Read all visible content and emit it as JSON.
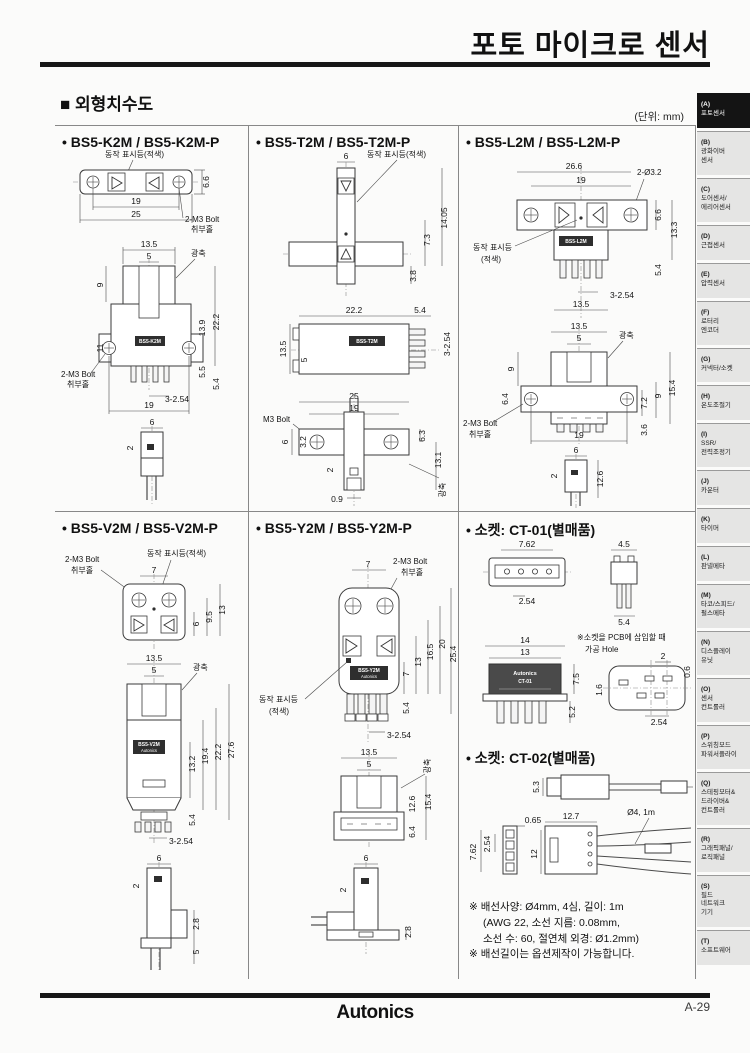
{
  "page": {
    "title": "포토 마이크로 센서",
    "section_title": "■ 외형치수도",
    "unit_note": "(단위: mm)",
    "footer_logo": "Autonics",
    "page_number": "A-29",
    "accent_color": "#171717"
  },
  "sidebar": {
    "items": [
      {
        "key": "(A)",
        "label": "포토센서",
        "active": true
      },
      {
        "key": "(B)",
        "label": "광화이버\n센서",
        "active": false
      },
      {
        "key": "(C)",
        "label": "도어센서/\n에리어센서",
        "active": false
      },
      {
        "key": "(D)",
        "label": "근접센서",
        "active": false
      },
      {
        "key": "(E)",
        "label": "압력센서",
        "active": false
      },
      {
        "key": "(F)",
        "label": "로터리\n엔코더",
        "active": false
      },
      {
        "key": "(G)",
        "label": "커넥터/소켓",
        "active": false
      },
      {
        "key": "(H)",
        "label": "온도조절기",
        "active": false
      },
      {
        "key": "(I)",
        "label": "SSR/\n전력조정기",
        "active": false
      },
      {
        "key": "(J)",
        "label": "카운터",
        "active": false
      },
      {
        "key": "(K)",
        "label": "타이머",
        "active": false
      },
      {
        "key": "(L)",
        "label": "판넬메타",
        "active": false
      },
      {
        "key": "(M)",
        "label": "타코/스피드/\n펄스메타",
        "active": false
      },
      {
        "key": "(N)",
        "label": "디스플레이\n유닛",
        "active": false
      },
      {
        "key": "(O)",
        "label": "센서\n컨트롤러",
        "active": false
      },
      {
        "key": "(P)",
        "label": "스위칭모드\n파워서플라이",
        "active": false
      },
      {
        "key": "(Q)",
        "label": "스테핑모터&\n드라이버&\n컨트롤러",
        "active": false
      },
      {
        "key": "(R)",
        "label": "그래픽패널/\n로직패널",
        "active": false
      },
      {
        "key": "(S)",
        "label": "필드\n네트워크\n기기",
        "active": false
      },
      {
        "key": "(T)",
        "label": "소프트웨어",
        "active": false
      }
    ]
  },
  "panels": {
    "k2m": {
      "title": "• BS5-K2M / BS5-K2M-P",
      "indicator": "동작 표시등(적색)",
      "bolt": "2-M3 Bolt",
      "bolt_hole": "취부홀",
      "axis": "광축",
      "model": "BS5-K2M",
      "pitch": "3-2.54",
      "top": [
        "19",
        "25",
        "6.6"
      ],
      "front": [
        "13.5",
        "5",
        "9",
        "11",
        "13.9",
        "22.2",
        "5.5",
        "5.4",
        "19"
      ],
      "side": [
        "6",
        "0.9",
        "2"
      ]
    },
    "t2m": {
      "title": "• BS5-T2M / BS5-T2M-P",
      "indicator": "동작 표시등(적색)",
      "axis": "광축",
      "bolt": "M3 Bolt",
      "model": "BS5-T2M",
      "pitch": "3-2.54",
      "top": [
        "6",
        "14.05",
        "7.3",
        "3.8"
      ],
      "mid": [
        "22.2",
        "5.4",
        "13.5",
        "5"
      ],
      "bottom": [
        "25",
        "19",
        "6",
        "3.2",
        "6.3",
        "13.1",
        "2",
        "0.9"
      ]
    },
    "l2m": {
      "title": "• BS5-L2M / BS5-L2M-P",
      "indicator_1": "동작 표시등",
      "indicator_2": "(적색)",
      "holes": "2-Ø3.2",
      "bolt": "2-M3 Bolt",
      "bolt_hole": "취부홀",
      "axis": "광축",
      "model": "BS5-L2M",
      "pitch": "3-2.54",
      "top": [
        "26.6",
        "19",
        "6.6",
        "13.3",
        "5.4",
        "13.5"
      ],
      "front": [
        "13.5",
        "5",
        "9",
        "6.4",
        "7.2",
        "9",
        "15.4",
        "3.6",
        "19"
      ],
      "side": [
        "6",
        "0.9",
        "2",
        "12.6"
      ]
    },
    "v2m": {
      "title": "• BS5-V2M / BS5-V2M-P",
      "bolt": "2-M3 Bolt",
      "bolt_hole": "취부홀",
      "indicator": "동작 표시등(적색)",
      "axis": "광축",
      "model": "BS5-V2M",
      "brand": "Autonics",
      "pitch": "3-2.54",
      "top": [
        "7",
        "6",
        "9.5",
        "13"
      ],
      "front": [
        "13.5",
        "5",
        "13.2",
        "19.4",
        "22.2",
        "27.6",
        "5.4"
      ],
      "side": [
        "6",
        "0.9",
        "2",
        "2.8",
        "5"
      ]
    },
    "y2m": {
      "title": "• BS5-Y2M / BS5-Y2M-P",
      "bolt": "2-M3 Bolt",
      "bolt_hole": "취부홀",
      "indicator_1": "동작 표시등",
      "indicator_2": "(적색)",
      "axis": "광축",
      "model": "BS5-Y2M",
      "brand": "Autonics",
      "pitch": "3-2.54",
      "front": [
        "7",
        "7",
        "13",
        "16.5",
        "20",
        "25.4",
        "5.4"
      ],
      "mid": [
        "13.5",
        "5",
        "12.6",
        "15.4",
        "6.4"
      ],
      "side": [
        "6",
        "0.9",
        "2",
        "2.8"
      ]
    },
    "sockets": {
      "ct01_title": "• 소켓: CT-01(별매품)",
      "ct02_title": "• 소켓: CT-02(별매품)",
      "pcb_note_1": "※소켓을 PCB에 삽입할 때",
      "pcb_note_2": "가공 Hole",
      "brand": "Autonics",
      "model": "CT-01",
      "ct01": [
        "7.62",
        "2.54",
        "4.5",
        "5.4",
        "14",
        "13",
        "7.5",
        "5.2",
        "2",
        "0.6",
        "1.6",
        "2.54"
      ],
      "ct02": [
        "5.3",
        "0.65",
        "12.7",
        "Ø4, 1m",
        "2.54",
        "7.62",
        "12"
      ],
      "notes": [
        "※ 배선사양: Ø4mm, 4심, 길이: 1m",
        "(AWG 22, 소선 지름: 0.08mm,",
        "소선 수: 60, 절연체 외경: Ø1.2mm)",
        "※ 배선길이는 옵션제작이 가능합니다."
      ]
    }
  }
}
